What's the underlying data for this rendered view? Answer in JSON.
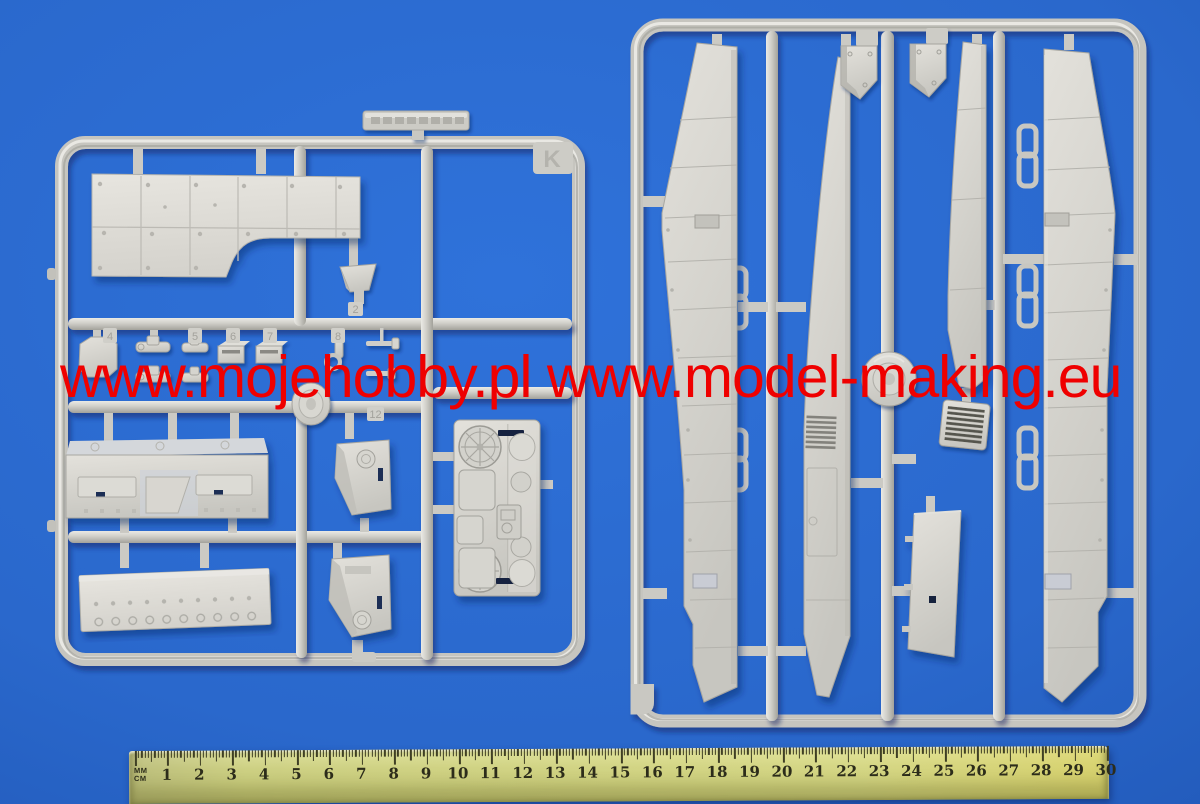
{
  "watermark": {
    "text": "www.mojehobby.pl www.model-making.eu",
    "color": "#ef0000"
  },
  "sprues": {
    "left": {
      "letter": "K",
      "part_tabs": [
        "4",
        "5",
        "6",
        "7",
        "8",
        "2",
        "12"
      ]
    },
    "right": {}
  },
  "ruler": {
    "label_top": "MM",
    "label_bottom": "CM",
    "numbers": [
      "1",
      "2",
      "3",
      "4",
      "5",
      "6",
      "7",
      "8",
      "9",
      "10",
      "11",
      "12",
      "13",
      "14",
      "15",
      "16",
      "17",
      "18",
      "19",
      "20",
      "21",
      "22",
      "23",
      "24",
      "25",
      "26",
      "27",
      "28",
      "29",
      "30"
    ]
  },
  "colors": {
    "background_blue": "#2a68cc",
    "plastic_light": "#dddcd6",
    "plastic_mid": "#c9c8c2",
    "plastic_shadow": "#a5a49d",
    "slot_navy": "#1d2f55",
    "ruler_body": "#c9cc80",
    "watermark_red": "#ef0000"
  }
}
